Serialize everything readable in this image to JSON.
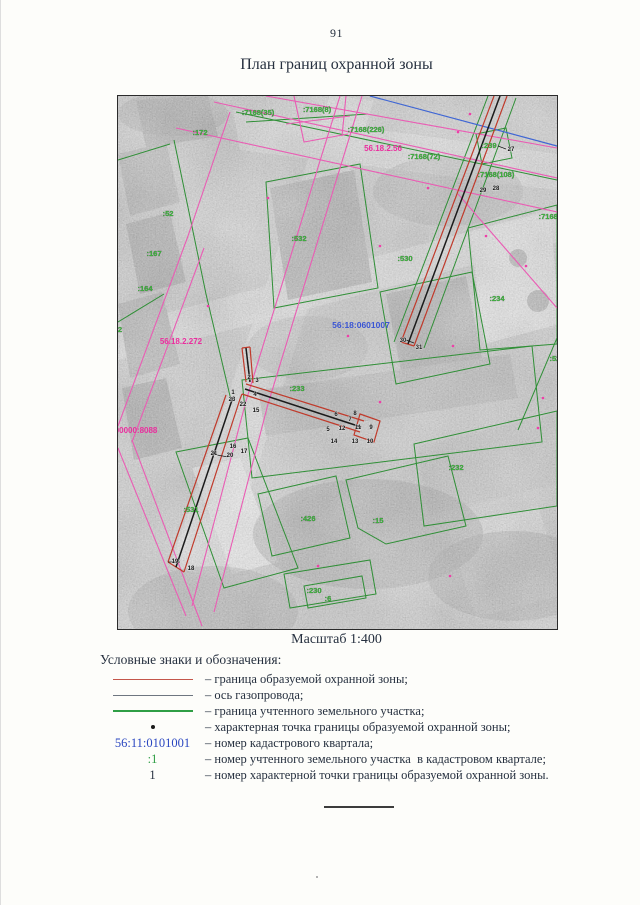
{
  "page": {
    "number": "91",
    "title": "План границ охранной зоны",
    "scale_caption": "Масштаб 1:400"
  },
  "map": {
    "quarter_number": "56:18:0601007",
    "green_labels": [
      ":7168(35)",
      ":7168(8)",
      ":172",
      ":7168(226)",
      ":7168(72)",
      ":239",
      ":7168(108)",
      ":7168(153)",
      ":52",
      ":167",
      ":164",
      ":532",
      ":530",
      ":234",
      ":528",
      ":233",
      ":232",
      ":531",
      ":426",
      ":15",
      ":230",
      ":6",
      "2"
    ],
    "magenta_labels": [
      "56.18.2.56",
      "56.18.2.272",
      "56:18:0000000:8088"
    ],
    "point_numbers": [
      "27",
      "28",
      "29",
      "30",
      "31",
      "2",
      "3",
      "1",
      "23",
      "4",
      "22",
      "15",
      "6",
      "8",
      "7",
      "5",
      "12",
      "11",
      "9",
      "14",
      "13",
      "10",
      "16",
      "17",
      "21",
      "20",
      "19",
      "18"
    ]
  },
  "legend": {
    "heading": "Условные знаки и обозначения:",
    "rows": [
      {
        "label": "– граница образуемой охранной зоны;"
      },
      {
        "label": "– ось газопровода;"
      },
      {
        "label": "– граница учтенного земельного участка;"
      },
      {
        "label": "– характерная точка границы образуемой охранной зоны;"
      },
      {
        "symbol_text": "56:11:0101001",
        "label": "– номер кадастрового квартала;"
      },
      {
        "symbol_text": ":1",
        "label": "– номер учтенного земельного участка  в кадастровом квартале;"
      },
      {
        "symbol_text": "1",
        "label": "– номер характерной точки границы образуемой охранной зоны."
      }
    ]
  },
  "colors": {
    "zone_boundary_red": "#c03a2b",
    "pipeline_axis_dark": "#1b1b1b",
    "parcel_green": "#2f8f36",
    "label_green": "#3ab53a",
    "cadastral_pink": "#ea5cb4",
    "quarter_blue": "#3a55d4",
    "legend_blue": "#2a46c0"
  }
}
